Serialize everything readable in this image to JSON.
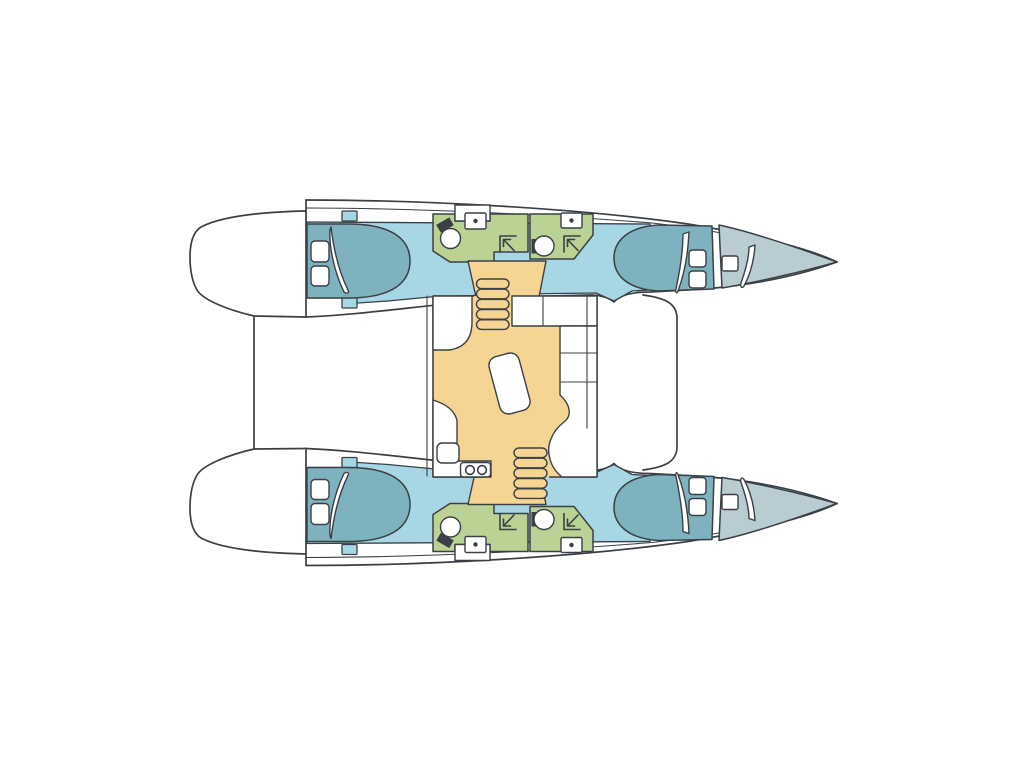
{
  "meta": {
    "image_type": "boat-floor-plan",
    "vessel_type": "catamaran",
    "view": "top-down deck plan",
    "orientation": "bow-right-stern-left",
    "visible_text": []
  },
  "palette": {
    "paper": "#ffffff",
    "outline": "#3a4045",
    "cabin_floor": "#a7d6e4",
    "bed": "#7eb2bf",
    "bathroom": "#bad394",
    "salon_floor": "#f6d592",
    "forepeak": "#b9ccd2",
    "fixture_white": "#ffffff"
  },
  "layout": {
    "hulls": [
      {
        "name": "port-hull",
        "position": "top",
        "rooms": [
          {
            "name": "aft-cabin",
            "features": [
              "double-berth",
              "two-pillows",
              "duvet-fold"
            ]
          },
          {
            "name": "aft-shower-room",
            "features": [
              "toilet",
              "washbasin",
              "shower-corner"
            ]
          },
          {
            "name": "forward-shower-room",
            "features": [
              "toilet",
              "washbasin",
              "shower-corner"
            ]
          },
          {
            "name": "forward-cabin",
            "features": [
              "double-berth",
              "two-pillows",
              "duvet-fold"
            ]
          },
          {
            "name": "forepeak",
            "features": [
              "deck-hatch",
              "duvet-fold"
            ]
          }
        ]
      },
      {
        "name": "starboard-hull",
        "position": "bottom",
        "rooms": [
          {
            "name": "aft-cabin",
            "features": [
              "double-berth",
              "two-pillows",
              "duvet-fold"
            ]
          },
          {
            "name": "aft-shower-room",
            "features": [
              "toilet",
              "washbasin",
              "shower-corner"
            ]
          },
          {
            "name": "forward-shower-room",
            "features": [
              "toilet",
              "washbasin",
              "shower-corner"
            ]
          },
          {
            "name": "forward-cabin",
            "features": [
              "double-berth",
              "two-pillows",
              "duvet-fold"
            ]
          },
          {
            "name": "forepeak",
            "features": [
              "deck-hatch",
              "duvet-fold"
            ]
          }
        ]
      }
    ],
    "bridgedeck": {
      "rooms": [
        {
          "name": "saloon",
          "features": [
            "l-shaped-sofa",
            "dinette-table",
            "galley-sink",
            "two-burner-stove",
            "galley-counter",
            "companionway-stairs-port",
            "companionway-stairs-starboard"
          ]
        },
        {
          "name": "forward-cockpit",
          "features": [
            "rounded-coaming"
          ]
        },
        {
          "name": "aft-deck",
          "features": [
            "transom-platform-outline"
          ]
        }
      ]
    }
  }
}
